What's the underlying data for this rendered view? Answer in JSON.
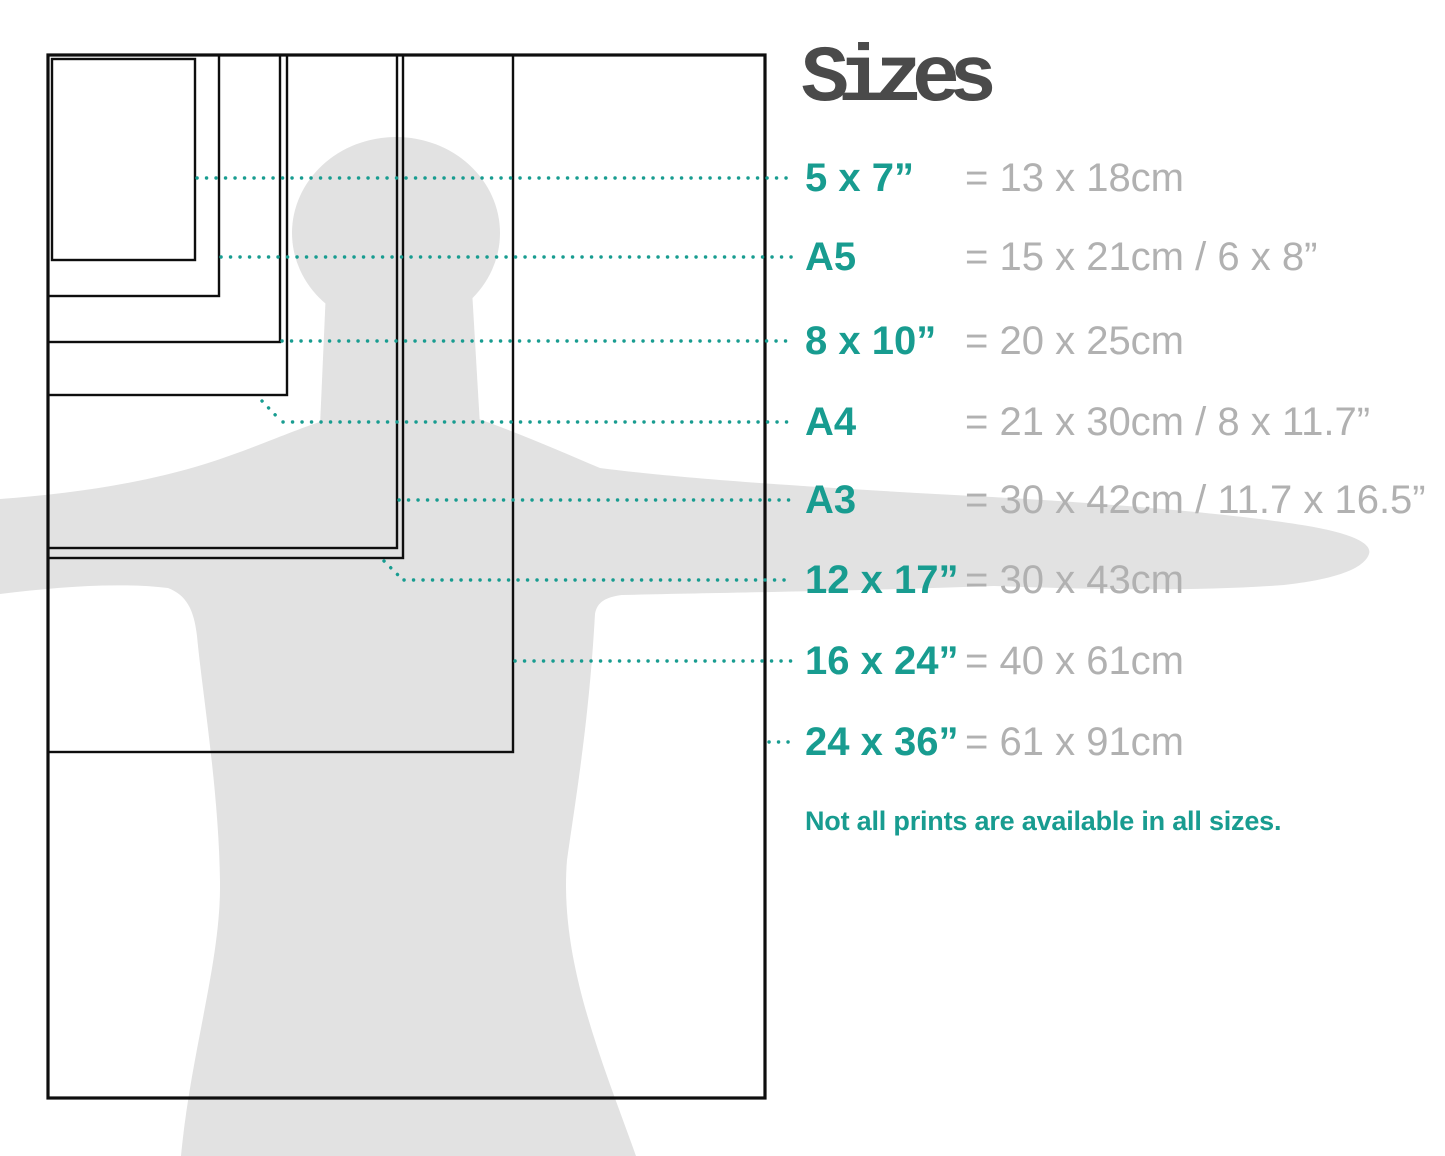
{
  "title": "Sizes",
  "legend": {
    "rows": [
      {
        "id": "5x7",
        "label": "5 x 7”",
        "value": "= 13 x 18cm"
      },
      {
        "id": "a5",
        "label": "A5",
        "value": "= 15 x 21cm / 6 x 8”"
      },
      {
        "id": "8x10",
        "label": "8 x 10”",
        "value": "= 20 x 25cm"
      },
      {
        "id": "a4",
        "label": "A4",
        "value": "= 21 x 30cm / 8 x 11.7”"
      },
      {
        "id": "a3",
        "label": "A3",
        "value": "= 30 x 42cm / 11.7 x 16.5”"
      },
      {
        "id": "12x17",
        "label": "12 x 17”",
        "value": "= 30 x 43cm"
      },
      {
        "id": "16x24",
        "label": "16 x 24”",
        "value": "= 40 x 61cm"
      },
      {
        "id": "24x36",
        "label": "24 x 36”",
        "value": "= 61 x 91cm"
      }
    ]
  },
  "note": "Not all prints are available in all sizes.",
  "colors": {
    "accent_teal": "#189c90",
    "value_gray": "#b1b1b1",
    "title_gray": "#4a4a4a",
    "silhouette_gray": "#e2e2e2",
    "rectangle_black": "#0e0e0e"
  }
}
